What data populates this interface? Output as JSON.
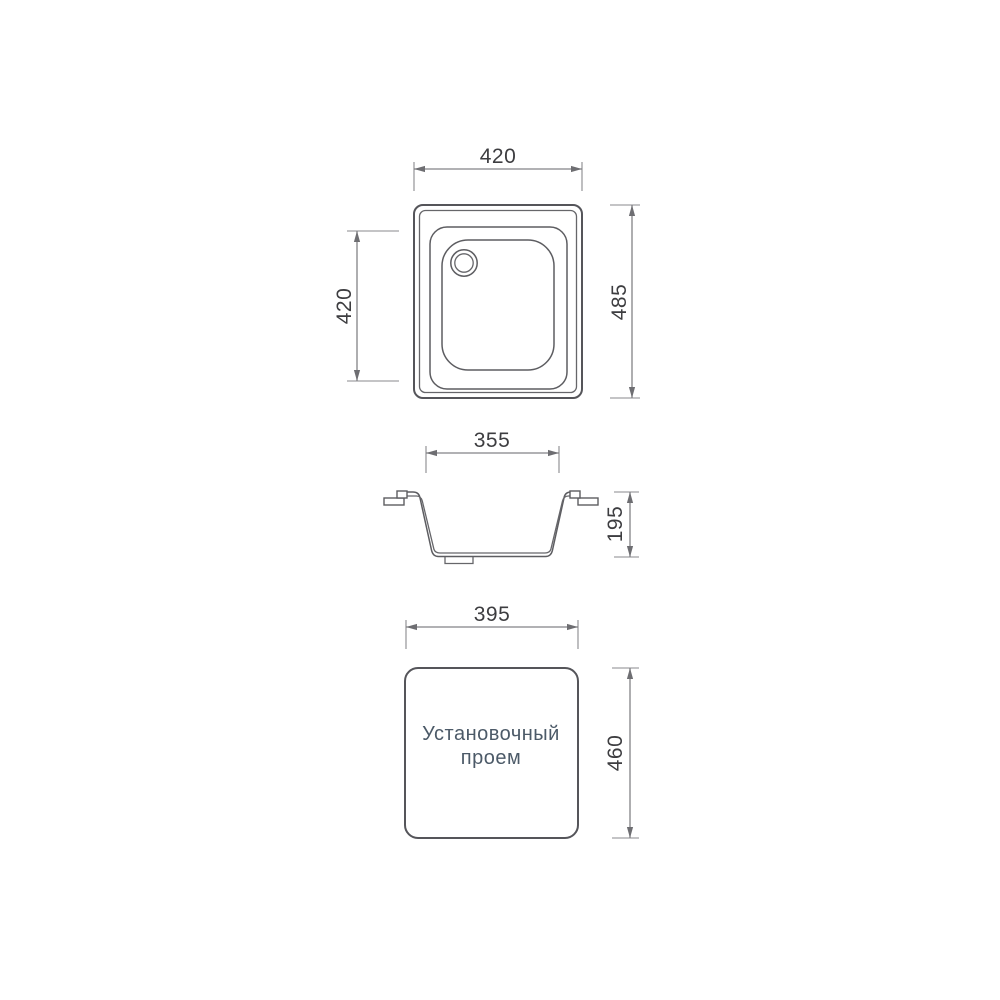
{
  "colors": {
    "background": "#ffffff",
    "outline": "#55555a",
    "dimension_line": "#828286",
    "dimension_text": "#3d3d40",
    "cutout_text": "#4c5a68"
  },
  "top_view": {
    "dim_width": "420",
    "dim_bowl_length": "420",
    "dim_height": "485"
  },
  "section_view": {
    "dim_opening_width": "355",
    "dim_depth": "195"
  },
  "cutout_view": {
    "dim_width": "395",
    "dim_height": "460",
    "label_line1": "Установочный",
    "label_line2": "проем"
  }
}
